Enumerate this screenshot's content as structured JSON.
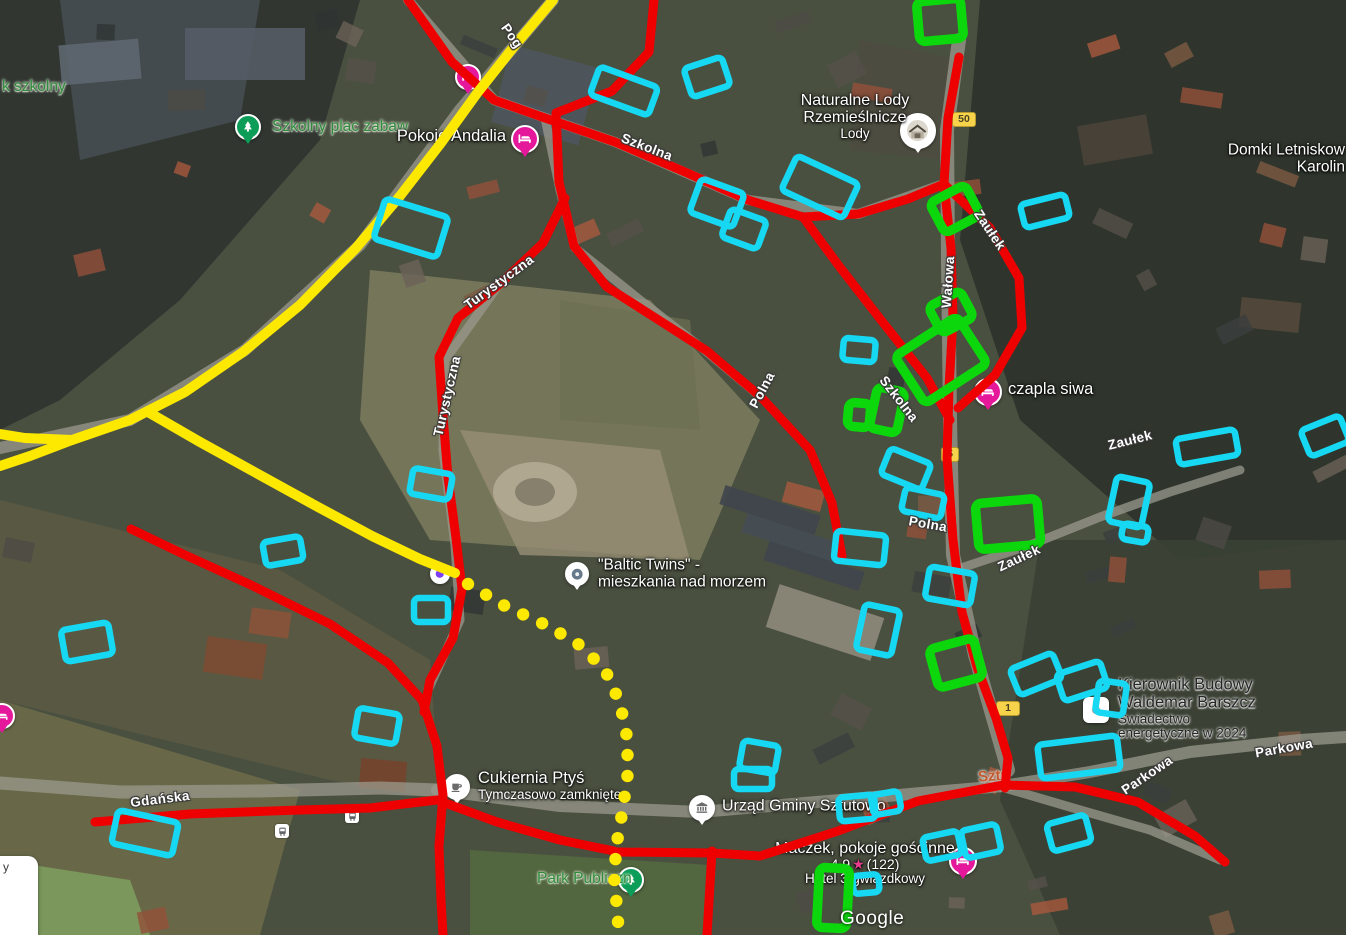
{
  "map": {
    "watermark": {
      "text": "Google",
      "x": 840,
      "y": 908
    },
    "edge_fragment": {
      "text": "y",
      "x": 3,
      "y": 860
    },
    "colors": {
      "red": "#ee0000",
      "yellow": "#fde900",
      "cyan": "#17d8f2",
      "green": "#0cd60c",
      "pin_magenta": "#e5189c",
      "pin_green": "#0c9d58",
      "badge_bg": "#f7d24b",
      "rating_star": "#ea3b8e",
      "locality_orange": "#c05a2e"
    },
    "pois": [
      {
        "id": "park-szkolny",
        "align": "left",
        "x": 2,
        "y": 88,
        "color": "green",
        "lines": [
          {
            "text": "k szkolny",
            "size": 15.5
          }
        ]
      },
      {
        "id": "szkolny-plac-zabaw",
        "align": "left",
        "x": 272,
        "y": 128,
        "color": "green",
        "lines": [
          {
            "text": "Szkolny plac zabaw",
            "size": 15.5
          }
        ],
        "pin": {
          "type": "tree",
          "x": 248,
          "y": 127,
          "r": 13
        }
      },
      {
        "id": "pokoje-andalia",
        "align": "right",
        "x": 506,
        "y": 138,
        "color": "white",
        "lines": [
          {
            "text": "Pokoje Andalia",
            "size": 16.5
          }
        ],
        "pin": {
          "type": "bed",
          "x": 525,
          "y": 139,
          "r": 14
        }
      },
      {
        "id": "naturalne-lody",
        "align": "center",
        "x": 855,
        "y": 119,
        "color": "white",
        "lines": [
          {
            "text": "Naturalne Lody",
            "size": 16
          },
          {
            "text": "Rzemieślnicze",
            "size": 16
          },
          {
            "text": "Lody",
            "size": 13.5
          }
        ],
        "pin": {
          "type": "photo",
          "x": 918,
          "y": 131,
          "r": 18
        }
      },
      {
        "id": "domki-letniskowe",
        "align": "right",
        "x": 1345,
        "y": 161,
        "color": "white",
        "lines": [
          {
            "text": "Domki Letniskow",
            "size": 15.5
          },
          {
            "text": "Karolin",
            "size": 15.5
          }
        ]
      },
      {
        "id": "czapla-siwa",
        "align": "left",
        "x": 1008,
        "y": 391,
        "color": "white",
        "lines": [
          {
            "text": "czapla siwa",
            "size": 16.5
          }
        ],
        "pin": {
          "type": "bed",
          "x": 988,
          "y": 392,
          "r": 14
        }
      },
      {
        "id": "baltic-twins",
        "align": "left",
        "x": 598,
        "y": 576,
        "color": "white",
        "lines": [
          {
            "text": "\"Baltic Twins\" -",
            "size": 15.5
          },
          {
            "text": "mieszkania nad morzem",
            "size": 15.5
          }
        ],
        "pin": {
          "type": "dot",
          "x": 577,
          "y": 574,
          "r": 12
        }
      },
      {
        "id": "cukiernia-ptys",
        "align": "left",
        "x": 478,
        "y": 788,
        "color": "white",
        "lines": [
          {
            "text": "Cukiernia Ptyś",
            "size": 16.5
          },
          {
            "text": "Tymczasowo zamknięte",
            "size": 13.5
          }
        ],
        "pin": {
          "type": "coffee",
          "x": 457,
          "y": 787,
          "r": 13
        }
      },
      {
        "id": "urzad-gminy",
        "align": "left",
        "x": 722,
        "y": 807,
        "color": "white",
        "lines": [
          {
            "text": "Urząd Gminy Sztutowo",
            "size": 16
          }
        ],
        "pin": {
          "type": "bank",
          "x": 702,
          "y": 808,
          "r": 13
        }
      },
      {
        "id": "kierownik-budowy",
        "align": "left",
        "x": 1118,
        "y": 712,
        "color": "dark",
        "lines": [
          {
            "text": "Kierownik Budowy",
            "size": 16.5
          },
          {
            "text": "Waldemar Barszcz",
            "size": 16.5
          },
          {
            "text": "Świadectwo",
            "size": 13.5
          },
          {
            "text": "energetyczne w 2024",
            "size": 13.5
          }
        ],
        "pin": {
          "type": "square-dot",
          "x": 1096,
          "y": 710,
          "r": 13
        }
      },
      {
        "id": "maczek",
        "align": "center",
        "x": 865,
        "y": 866,
        "color": "white",
        "lines": [
          {
            "text": "Maczek, pokoje gościnne",
            "size": 16
          },
          {
            "rating": true,
            "value": "4.9",
            "star": "★",
            "count": "(122)",
            "size": 14
          },
          {
            "text": "Hotel 3-gwiazdkowy",
            "size": 13.5
          }
        ],
        "pin": {
          "type": "bed",
          "x": 963,
          "y": 861,
          "r": 14
        }
      },
      {
        "id": "park-publiczny",
        "align": "left",
        "x": 537,
        "y": 880,
        "color": "green",
        "lines": [
          {
            "text": "Park Publiczn",
            "size": 15.5
          }
        ],
        "pin": {
          "type": "tree",
          "x": 631,
          "y": 880,
          "r": 13
        }
      }
    ],
    "street_labels": [
      {
        "text": "Pog",
        "x": 512,
        "y": 36,
        "rot": 55
      },
      {
        "text": "Szkolna",
        "x": 647,
        "y": 147,
        "rot": 21
      },
      {
        "text": "Turystyczna",
        "x": 499,
        "y": 282,
        "rot": -36
      },
      {
        "text": "Turystyczna",
        "x": 447,
        "y": 396,
        "rot": -77
      },
      {
        "text": "Polna",
        "x": 762,
        "y": 390,
        "rot": -62
      },
      {
        "text": "Wałowa",
        "x": 948,
        "y": 282,
        "rot": -86
      },
      {
        "text": "Zaułek",
        "x": 990,
        "y": 230,
        "rot": 56
      },
      {
        "text": "Szkolna",
        "x": 899,
        "y": 399,
        "rot": 52
      },
      {
        "text": "Polna",
        "x": 928,
        "y": 524,
        "rot": 10
      },
      {
        "text": "Zaułek",
        "x": 1019,
        "y": 558,
        "rot": -25
      },
      {
        "text": "Zaułek",
        "x": 1130,
        "y": 440,
        "rot": -14
      },
      {
        "text": "Gdańska",
        "x": 160,
        "y": 799,
        "rot": -7
      },
      {
        "text": "Parkowa",
        "x": 1284,
        "y": 748,
        "rot": -10
      },
      {
        "text": "Parkowa",
        "x": 1147,
        "y": 775,
        "rot": -34
      }
    ],
    "locality_labels": [
      {
        "text": "Sztu",
        "x": 978,
        "y": 776,
        "rot": -4
      }
    ],
    "road_badges": [
      {
        "text": "50",
        "x": 952,
        "y": 112,
        "w": 22
      },
      {
        "text": "5",
        "x": 941,
        "y": 447,
        "w": 16
      },
      {
        "text": "1",
        "x": 996,
        "y": 701,
        "w": 22
      }
    ],
    "small_icons": [
      {
        "type": "bus",
        "x": 352,
        "y": 816
      },
      {
        "type": "bus",
        "x": 282,
        "y": 831
      },
      {
        "type": "violet-dot",
        "x": 440,
        "y": 574
      },
      {
        "type": "bed-partial",
        "x": 468,
        "y": 77
      },
      {
        "type": "bed-partial",
        "x": 2,
        "y": 716
      }
    ],
    "annotations": {
      "red_roads": [
        "408,0 452,62 494,100 545,118 615,142 685,172 748,200 803,217 858,214 908,199 944,184",
        "654,0 649,52 612,91 556,113",
        "556,113 559,182 574,246 607,287 654,317 707,351 761,397 810,450 832,503 842,556",
        "803,217 839,266 881,320 927,378 950,420",
        "959,57 948,118 944,184 951,248 953,318 949,388 947,458 953,540 962,612 977,667 996,718 1008,758 1005,788",
        "944,184 990,228 1019,278 1022,328 995,375 958,408",
        "131,529 183,554 251,585 330,624 388,663 422,700 437,746 443,795 439,846 441,900 443,935",
        "95,822 190,814 300,810 370,808 437,800",
        "437,800 497,822 560,840 614,851",
        "618,852 712,853",
        "712,851 707,935",
        "712,853 760,856 838,831 918,801 1003,785",
        "1003,785 1075,787 1138,802 1195,836 1225,862",
        "565,198 543,243 501,283 458,318 439,357 443,416 448,477 456,538 462,589 453,638 430,680 424,712"
      ],
      "yellow_roads": [
        "553,0 516,44 478,92 441,143 400,196 356,248 300,305 243,352 185,392 130,420 72,440 25,438 0,434",
        "72,440 30,456 0,466",
        "148,412 200,442 258,474 318,507 372,536 420,559 455,573"
      ],
      "dotted_path": "468,584 505,606 548,626 583,647 606,672 620,703 627,737 628,772 623,808 617,842 614,876 617,908 619,935",
      "cyan_buildings": [
        {
          "cx": 624,
          "cy": 91,
          "w": 62,
          "h": 30,
          "rot": 20
        },
        {
          "cx": 707,
          "cy": 77,
          "w": 40,
          "h": 30,
          "rot": -18
        },
        {
          "cx": 717,
          "cy": 203,
          "w": 46,
          "h": 36,
          "rot": 20
        },
        {
          "cx": 744,
          "cy": 229,
          "w": 38,
          "h": 30,
          "rot": 20
        },
        {
          "cx": 820,
          "cy": 187,
          "w": 68,
          "h": 38,
          "rot": 25
        },
        {
          "cx": 1045,
          "cy": 211,
          "w": 46,
          "h": 24,
          "rot": -14
        },
        {
          "cx": 411,
          "cy": 228,
          "w": 66,
          "h": 42,
          "rot": 17
        },
        {
          "cx": 859,
          "cy": 350,
          "w": 32,
          "h": 22,
          "rot": 5
        },
        {
          "cx": 906,
          "cy": 469,
          "w": 44,
          "h": 28,
          "rot": 22
        },
        {
          "cx": 923,
          "cy": 503,
          "w": 40,
          "h": 24,
          "rot": 12
        },
        {
          "cx": 860,
          "cy": 548,
          "w": 50,
          "h": 30,
          "rot": 6
        },
        {
          "cx": 950,
          "cy": 586,
          "w": 46,
          "h": 32,
          "rot": 10
        },
        {
          "cx": 878,
          "cy": 630,
          "w": 36,
          "h": 46,
          "rot": 12
        },
        {
          "cx": 1207,
          "cy": 447,
          "w": 60,
          "h": 26,
          "rot": -10
        },
        {
          "cx": 1325,
          "cy": 436,
          "w": 42,
          "h": 28,
          "rot": -22
        },
        {
          "cx": 1129,
          "cy": 502,
          "w": 34,
          "h": 46,
          "rot": 12
        },
        {
          "cx": 1135,
          "cy": 533,
          "w": 26,
          "h": 16,
          "rot": 10
        },
        {
          "cx": 1036,
          "cy": 674,
          "w": 46,
          "h": 28,
          "rot": -22
        },
        {
          "cx": 1082,
          "cy": 681,
          "w": 46,
          "h": 28,
          "rot": -18
        },
        {
          "cx": 1111,
          "cy": 698,
          "w": 28,
          "h": 32,
          "rot": 8
        },
        {
          "cx": 1079,
          "cy": 757,
          "w": 80,
          "h": 34,
          "rot": -7
        },
        {
          "cx": 87,
          "cy": 642,
          "w": 48,
          "h": 32,
          "rot": -10
        },
        {
          "cx": 283,
          "cy": 551,
          "w": 38,
          "h": 24,
          "rot": -10
        },
        {
          "cx": 431,
          "cy": 484,
          "w": 40,
          "h": 26,
          "rot": 10
        },
        {
          "cx": 431,
          "cy": 610,
          "w": 34,
          "h": 24,
          "rot": 0
        },
        {
          "cx": 377,
          "cy": 726,
          "w": 42,
          "h": 30,
          "rot": 10
        },
        {
          "cx": 145,
          "cy": 833,
          "w": 62,
          "h": 34,
          "rot": 12
        },
        {
          "cx": 759,
          "cy": 757,
          "w": 36,
          "h": 28,
          "rot": 10
        },
        {
          "cx": 753,
          "cy": 779,
          "w": 38,
          "h": 20,
          "rot": 0
        },
        {
          "cx": 857,
          "cy": 808,
          "w": 36,
          "h": 24,
          "rot": -5
        },
        {
          "cx": 886,
          "cy": 803,
          "w": 28,
          "h": 20,
          "rot": -10
        },
        {
          "cx": 942,
          "cy": 846,
          "w": 36,
          "h": 24,
          "rot": -12
        },
        {
          "cx": 981,
          "cy": 841,
          "w": 36,
          "h": 28,
          "rot": -12
        },
        {
          "cx": 1069,
          "cy": 833,
          "w": 40,
          "h": 28,
          "rot": -15
        },
        {
          "cx": 866,
          "cy": 884,
          "w": 26,
          "h": 18,
          "rot": -5
        }
      ],
      "green_buildings": [
        {
          "cx": 940,
          "cy": 20,
          "w": 44,
          "h": 40,
          "rot": -5
        },
        {
          "cx": 955,
          "cy": 209,
          "w": 40,
          "h": 34,
          "rot": -28
        },
        {
          "cx": 951,
          "cy": 312,
          "w": 36,
          "h": 30,
          "rot": -28
        },
        {
          "cx": 941,
          "cy": 360,
          "w": 74,
          "h": 56,
          "rot": -33
        },
        {
          "cx": 859,
          "cy": 415,
          "w": 22,
          "h": 24,
          "rot": 5
        },
        {
          "cx": 887,
          "cy": 410,
          "w": 28,
          "h": 42,
          "rot": 12
        },
        {
          "cx": 1008,
          "cy": 524,
          "w": 62,
          "h": 46,
          "rot": -5
        },
        {
          "cx": 956,
          "cy": 663,
          "w": 46,
          "h": 40,
          "rot": -15
        },
        {
          "cx": 833,
          "cy": 898,
          "w": 30,
          "h": 60,
          "rot": 3
        }
      ]
    }
  }
}
